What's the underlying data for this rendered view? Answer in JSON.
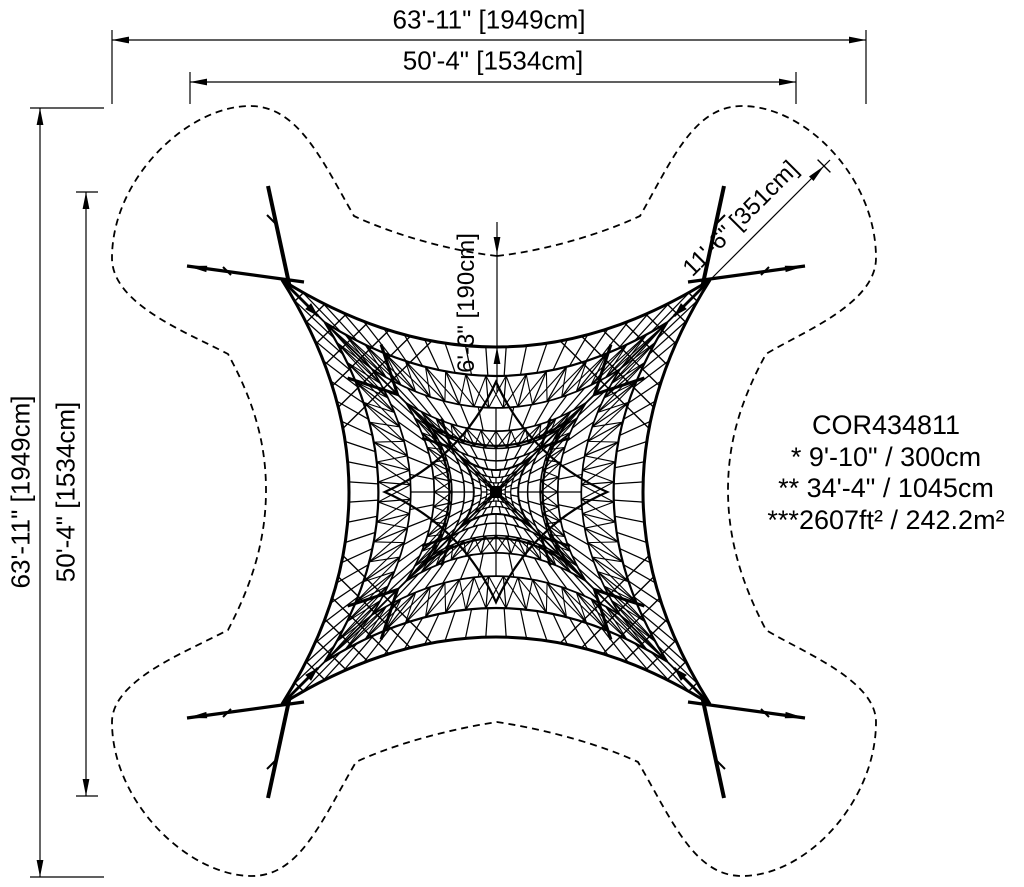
{
  "dimensions": {
    "top_outer": "63'-11\" [1949cm]",
    "top_inner": "50'-4\" [1534cm]",
    "left_outer": "63'-11\" [1949cm]",
    "left_inner": "50'-4\" [1534cm]",
    "pole_length": "11'-6\" [351cm]",
    "edge_clearance": "6'-3\" [190cm]"
  },
  "product": {
    "code": "COR434811",
    "specs": [
      "* 9'-10\" / 300cm",
      "** 34'-4\" / 1045cm",
      "***2607ft² / 242.2m²"
    ]
  },
  "colors": {
    "line": "#000000",
    "background": "#ffffff"
  }
}
